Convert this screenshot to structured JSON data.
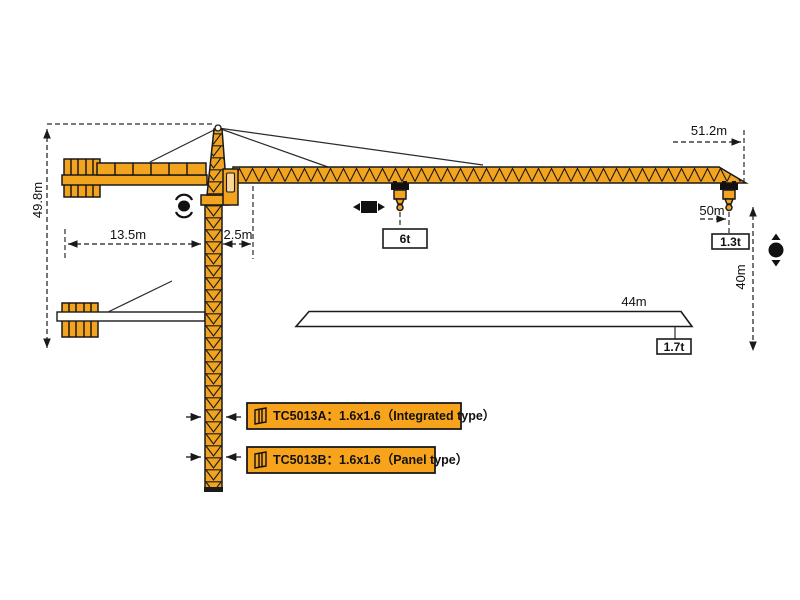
{
  "diagram": {
    "title": "tower crane working range diagram",
    "dimensions": {
      "total_height": "49.8m",
      "counter_jib_length": "13.5m",
      "tower_to_jib_offset": "2.5m",
      "jib_tip_radius": "51.2m",
      "max_hook_radius": "50m",
      "hook_height": "40m",
      "mid_span": "44m"
    },
    "loads": {
      "hook_load": "6t",
      "tip_load": "1.3t",
      "span_load": "1.7t"
    },
    "models": [
      {
        "label": "TC5013A：1.6x1.6（Integrated type）"
      },
      {
        "label": "TC5013B：1.6x1.6（Panel type）"
      }
    ],
    "symbols": {
      "slewing": "rotation-dot-with-arcs",
      "trolley_travel": "black-square-with-left-right-arrows",
      "hoist": "black-dot-with-up-down-arrows",
      "mast_section": "mast-section-glyph"
    },
    "colors": {
      "crane": "#F2A41F",
      "label_bg": "#F7A41C",
      "outline": "#1a1a1a"
    }
  }
}
